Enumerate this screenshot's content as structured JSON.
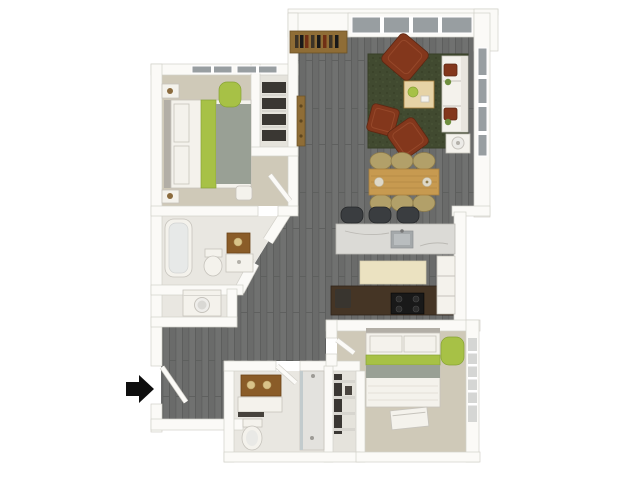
{
  "page": {
    "background": "#ffffff"
  },
  "colors": {
    "wall": "#fbfaf7",
    "wall-line": "#d2d0c9",
    "floor-dark": "#6a6b6a",
    "floor-dark-2": "#707170",
    "floor-line": "#5d5e5d",
    "carpet": "#cfc9b8",
    "bath-floor": "#e9e7e1",
    "closet-floor": "#e5e3dc",
    "tile-cream": "#ebe2c1",
    "tile-line": "#d8cfae",
    "rug-green": "#414a30",
    "rug-line": "#363e26",
    "accent-lime": "#a7c146",
    "lime-line": "#87a335",
    "armchair-rust": "#83371c",
    "rust-line": "#5e2712",
    "rust-inner": "#96482a",
    "wood-table": "#c79a50",
    "wood-line": "#a87f3c",
    "wood-light": "#e6d3a6",
    "wood-dark": "#8f6d36",
    "wood-dark-line": "#6b5226",
    "counter-dark": "#453525",
    "counter-line": "#30231a",
    "appliance-black": "#191919",
    "burner": "#2c2c2c",
    "marble": "#dbdad6",
    "marble-line": "#bbb9b4",
    "metal-gray": "#a4a8aa",
    "glass": "#989ea1",
    "slat-glass": "#d5d6d4",
    "white-furniture": "#f4f2ec",
    "furniture-line": "#c6c3bc",
    "gray-fabric": "#99a095",
    "fabric-line": "#e3e0d8",
    "headboard-gray": "#b2aea6",
    "stool-dark": "#3a3d40",
    "stool-line": "#26282a",
    "wicker": "#b2a069",
    "wicker-line": "#8f7c4a",
    "mirror-brown": "#8a5c28",
    "mirror-line": "#6b4317",
    "gold": "#d9c389",
    "dark-items": "#3a3733",
    "shelf-line": "#d7d5cf",
    "book-1": "#3c3326",
    "book-2": "#703015",
    "arrow-black": "#0e0e0e"
  },
  "floorplan": {
    "view": "3d-top-down-apartment-floor-plan",
    "entry": {
      "arrow_direction": "right"
    },
    "rooms": [
      {
        "id": "living-room",
        "floor": "dark-wood-plank",
        "furniture": [
          "window-wall",
          "console-bookshelf",
          "floor-lamp",
          "area-rug",
          "armchair",
          "armchair",
          "armchair",
          "coffee-table",
          "sofa",
          "side-table-with-lamp"
        ]
      },
      {
        "id": "dining-area",
        "floor": "dark-wood-plank",
        "furniture": [
          "dining-table",
          {
            "item": "dining-chair",
            "count": 6
          }
        ]
      },
      {
        "id": "kitchen",
        "floor": "dark-wood-plank",
        "furniture": [
          {
            "item": "bar-stool",
            "count": 3
          },
          "island-with-sink",
          "cooktop-counter",
          "tall-cabinet",
          "trash-bin",
          "cream-tile-mat"
        ]
      },
      {
        "id": "bedroom-1",
        "floor": "carpet",
        "furniture": [
          "bed",
          {
            "item": "nightstand",
            "count": 2
          },
          "accent-chair",
          "pouf",
          "windows"
        ]
      },
      {
        "id": "closet-1",
        "furniture": [
          "shelving"
        ]
      },
      {
        "id": "bathroom-1",
        "furniture": [
          "bathtub",
          "toilet",
          "vanity-with-mirror"
        ]
      },
      {
        "id": "laundry-closet",
        "furniture": [
          "washer"
        ]
      },
      {
        "id": "hallway",
        "floor": "dark-wood-plank"
      },
      {
        "id": "entry",
        "furniture": [
          "front-door"
        ]
      },
      {
        "id": "bathroom-2",
        "furniture": [
          "vanity-with-mirror",
          "toilet",
          "walk-in-shower"
        ]
      },
      {
        "id": "closet-2",
        "furniture": [
          "wire-shelving"
        ]
      },
      {
        "id": "bedroom-2",
        "floor": "carpet",
        "furniture": [
          "bed",
          "bench",
          "accent-chair",
          "windows"
        ]
      }
    ]
  }
}
